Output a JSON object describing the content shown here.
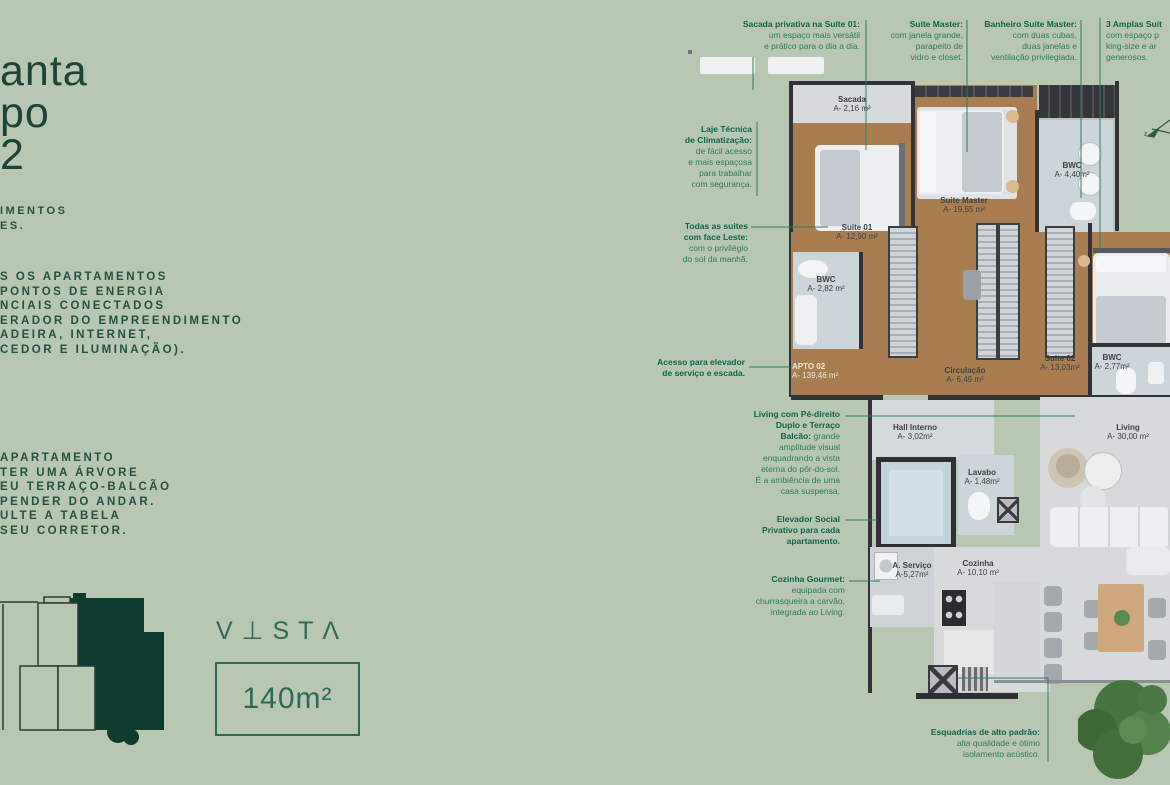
{
  "colors": {
    "background": "#b8c7b1",
    "accent_green": "#2d6a56",
    "annotation_green": "#10624b",
    "highlight_dark_green": "#0d3b2e",
    "wall": "#323237",
    "wood_floor": "#a87e51"
  },
  "left_panel": {
    "heading_lines": [
      "anta",
      "po",
      "2"
    ],
    "sub_lines": [
      "IMENTOS",
      "ES."
    ],
    "body_lines": [
      "S OS APARTAMENTOS",
      "PONTOS DE ENERGIA",
      "NCIAIS CONECTADOS",
      "ERADOR DO EMPREENDIMENTO",
      "ADEIRA, INTERNET,",
      "CEDOR E ILUMINAÇÃO)."
    ],
    "note_lines": [
      "APARTAMENTO",
      "TER UMA ÁRVORE",
      "EU TERRAÇO-BALCÃO",
      "PENDER DO ANDAR.",
      "ULTE A TABELA",
      "SEU CORRETOR."
    ],
    "logo": "V⊥STΛ",
    "area_badge": "140m²"
  },
  "annotations": {
    "sacada_privativa": {
      "bold": "Sacada privativa na Suíte 01:",
      "text": "\num espaço mais versátil\ne prático para o dia a dia."
    },
    "suite_master": {
      "bold": "Suíte Master:",
      "text": "\ncom janela grande,\nparapeito de\nvidro e closet."
    },
    "banheiro_suite_master": {
      "bold": "Banheiro Suíte Master:",
      "text": "\ncom duas cubas,\nduas janelas e\nventilação privilegiada."
    },
    "amplas_suites": {
      "bold": "3 Amplas Suít",
      "text": "\ncom espaço p\nking-size e ar\ngenerosos."
    },
    "laje_tecnica": {
      "bold": "Laje Técnica\nde Climatização:",
      "text": "\nde fácil acesso\ne mais espaçosa\npara trabalhar\ncom segurança."
    },
    "todas_suites": {
      "bold": "Todas as suites\ncom face Leste:",
      "text": "\ncom o privilégio\ndo sol da manhã."
    },
    "acesso_elevador": {
      "bold": "Acesso para elevador\nde serviço e escada.",
      "text": ""
    },
    "living_pe_direito": {
      "bold": "Living com Pé-direito\nDuplo e Terraço\nBalcão:",
      "text": " grande\namplitude visual\nenquadrando a vista\neterna do pôr-do-sol.\nÉ a ambiência de uma\ncasa suspensa."
    },
    "elevador_social": {
      "bold": "Elevador Social\nPrivativo para cada\napartamento.",
      "text": ""
    },
    "cozinha_gourmet": {
      "bold": "Cozinha Gourmet:",
      "text": "\nequipada com\nchurrasqueira a carvão,\nintegrada ao Living."
    },
    "esquadrias": {
      "bold": "Esquadrias de alto padrão:",
      "text": "\nalta qualidade e ótimo\nisolamento acústico."
    }
  },
  "floor_plan": {
    "apto": {
      "name": "APTO 02",
      "area": "A- 139,46 m²"
    },
    "rooms": {
      "sacada": {
        "name": "Sacada",
        "area": "A- 2,16 m²"
      },
      "suite01": {
        "name": "Suite 01",
        "area": "A- 12,90 m²"
      },
      "suite_master": {
        "name": "Suite Master",
        "area": "A- 19,55 m²"
      },
      "bwc_master": {
        "name": "BWC",
        "area": "A- 4,40m²"
      },
      "bwc_suite01": {
        "name": "BWC",
        "area": "A- 2,82 m²"
      },
      "circulacao": {
        "name": "Circulação",
        "area": "A- 6,49 m²"
      },
      "suite02": {
        "name": "Suite 02",
        "area": "A- 13,03m²"
      },
      "bwc_suite02": {
        "name": "BWC",
        "area": "A- 2,77m²"
      },
      "hall": {
        "name": "Hall Interno",
        "area": "A- 3,02m²"
      },
      "living": {
        "name": "Living",
        "area": "A- 30,00 m²"
      },
      "lavabo": {
        "name": "Lavabo",
        "area": "A- 1,48m²"
      },
      "servico": {
        "name": "A. Serviço",
        "area": "A-5,27m²"
      },
      "cozinha": {
        "name": "Cozinha",
        "area": "A- 10,10 m²"
      }
    },
    "compass_letter": "z"
  }
}
